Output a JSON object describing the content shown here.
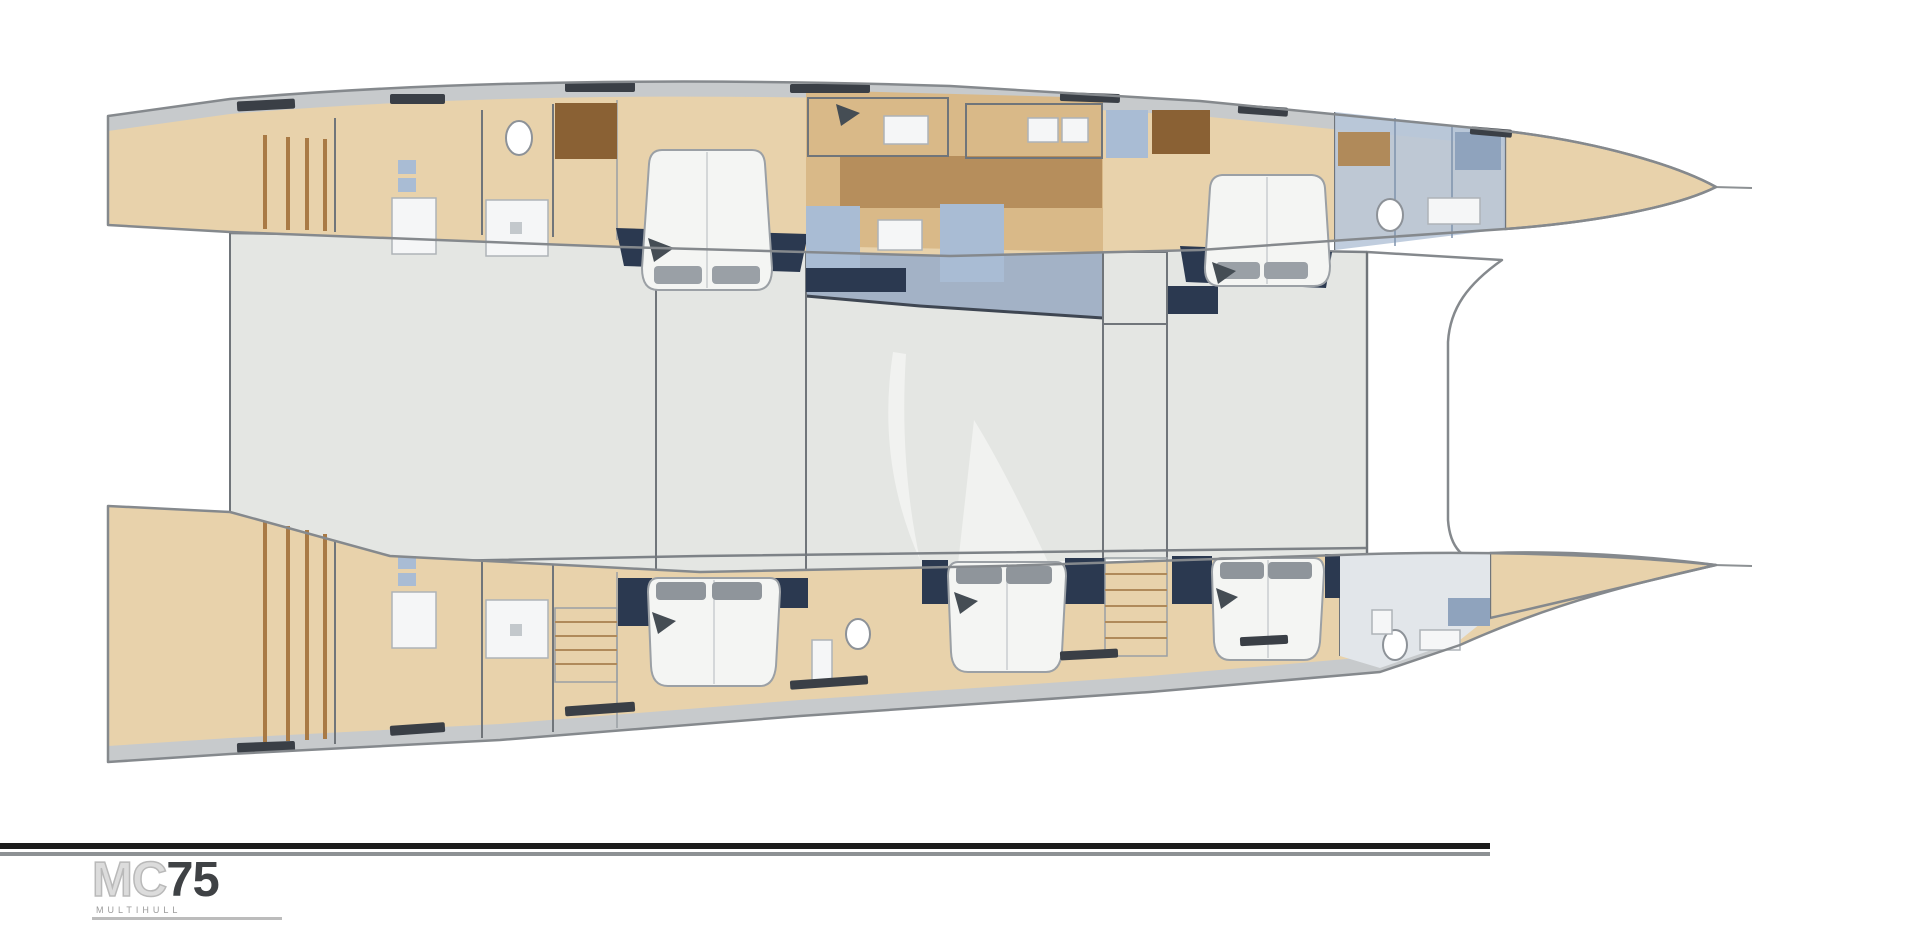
{
  "page": {
    "background": "#ffffff"
  },
  "footer": {
    "logo": {
      "brand": "MC",
      "model": "75",
      "subtitle": "MULTIHULL"
    }
  },
  "diagram": {
    "type": "catamaran-deck-plan",
    "icons": [
      "toilet-icon",
      "shower-icon",
      "double-bed-icon",
      "pillow-icon",
      "stairs-icon",
      "galley-counter-icon",
      "sailboat-watermark-icon",
      "deck-steps-icon",
      "roof-hatch-icon"
    ]
  },
  "colors": {
    "wood_light": "#e8d2ab",
    "wood_mid": "#d9b988",
    "wood_dark": "#a97a45",
    "stairs_brown": "#8a6134",
    "deck_gray": "#c7cacc",
    "saloon_gray": "#e4e6e3",
    "galley_floor": "#a3b2c6",
    "hull_outline": "#85898d",
    "wall_line": "#70757a",
    "navy": "#2b3950",
    "counter_blue": "#a9bcd4",
    "counter_blue_dark": "#8fa3bd",
    "glass_blue": "#b7c6da",
    "bed_white": "#f4f5f3",
    "pillow_gray": "#9aa0a6",
    "pillow_dark": "#8f959b",
    "hatch_dark": "#3a3f46",
    "watermark": "#f1f2f0",
    "rule_dark": "#1c1c1c",
    "rule_gray": "#8d9194",
    "logo_light": "#dcdcdc",
    "logo_dark": "#3f4245",
    "logo_sub": "#9a9a9a"
  }
}
